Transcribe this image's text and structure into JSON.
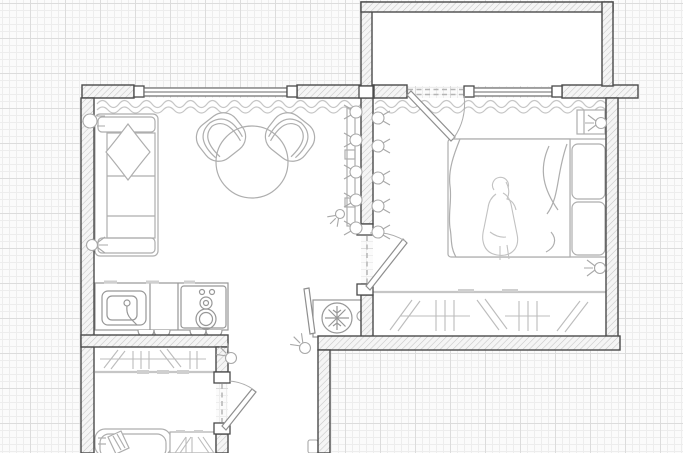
{
  "app": {
    "name": "floor-plan-canvas",
    "description": "Apartment floor plan drawing on graph paper grid; no visible text labels in the drawing"
  },
  "colors": {
    "canvas_bg": "#fbfbfb",
    "grid_minor": "#ededed",
    "grid_major": "#dcdcdc",
    "wall_stroke": "#4a4a4a",
    "room_fill": "#ffffff",
    "furniture_stroke": "#aeaeae",
    "appliance_stroke": "#979797",
    "door_stroke": "#8f8f8f",
    "curtain_color": "#c6c6c6"
  },
  "rooms": [
    {
      "id": "living-room",
      "contents": [
        "sofa",
        "throw-pillow",
        "armchair-left",
        "armchair-right",
        "coffee-table",
        "kitchen-counter",
        "kitchen-sink",
        "kitchen-stove",
        "air-conditioner",
        "wall-shelf",
        "curtain",
        "window"
      ]
    },
    {
      "id": "bedroom",
      "contents": [
        "double-bed",
        "pillows",
        "blanket",
        "person-figure",
        "nightstand",
        "wardrobe-rail",
        "curtain",
        "balcony-door",
        "window"
      ]
    },
    {
      "id": "balcony",
      "contents": []
    },
    {
      "id": "hallway",
      "contents": [
        "utility-pipe"
      ]
    },
    {
      "id": "bathroom-closet",
      "contents": [
        "coat-rail",
        "coat-hangers",
        "bathtub",
        "laundry-closet"
      ]
    }
  ],
  "symbols": [
    {
      "name": "radiator-valve",
      "count": 6
    },
    {
      "name": "wall-hooks",
      "count": 9
    },
    {
      "name": "air-conditioner-snowflake",
      "count": 1
    },
    {
      "name": "door-swing-arc",
      "count": 3
    }
  ]
}
